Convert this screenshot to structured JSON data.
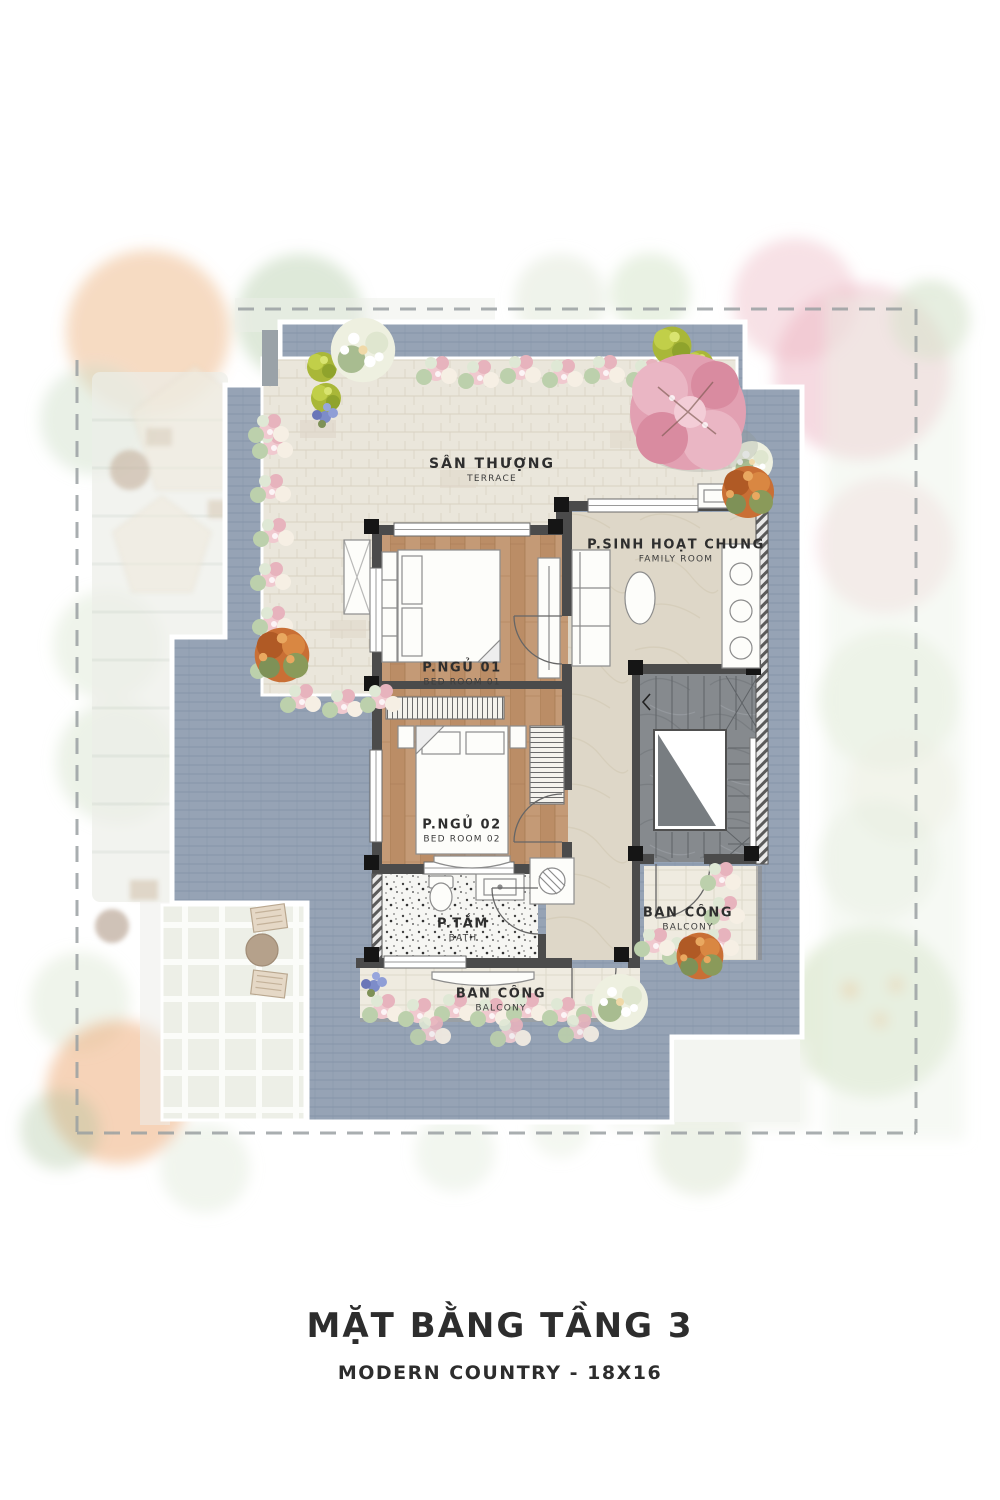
{
  "title": {
    "main": "MẶT BẰNG TẦNG 3",
    "subtitle": "MODERN COUNTRY - 18X16"
  },
  "rooms": {
    "terrace": {
      "name": "SÂN THƯỢNG",
      "name_en": "TERRACE"
    },
    "family_room": {
      "name": "P.SINH HOẠT CHUNG",
      "name_en": "FAMILY ROOM"
    },
    "bedroom_1": {
      "name": "P.NGỦ 01",
      "name_en": "BED ROOM 01"
    },
    "bedroom_2": {
      "name": "P.NGỦ 02",
      "name_en": "BED ROOM 02"
    },
    "bath": {
      "name": "P.TẮM",
      "name_en": "BATH"
    },
    "balcony_rear": {
      "name": "BAN CÔNG",
      "name_en": "BALCONY"
    },
    "balcony_side": {
      "name": "BAN CÔNG",
      "name_en": "BALCONY"
    }
  },
  "palette": {
    "deck_tile": "#96a3b5",
    "terrace_stone": "#eae6db",
    "wood_floor": "#c49a76",
    "marble": "#ded7c8",
    "stair_stone": "#868a8e",
    "wall": "#4b4b4b",
    "text": "#2d2d2d"
  }
}
